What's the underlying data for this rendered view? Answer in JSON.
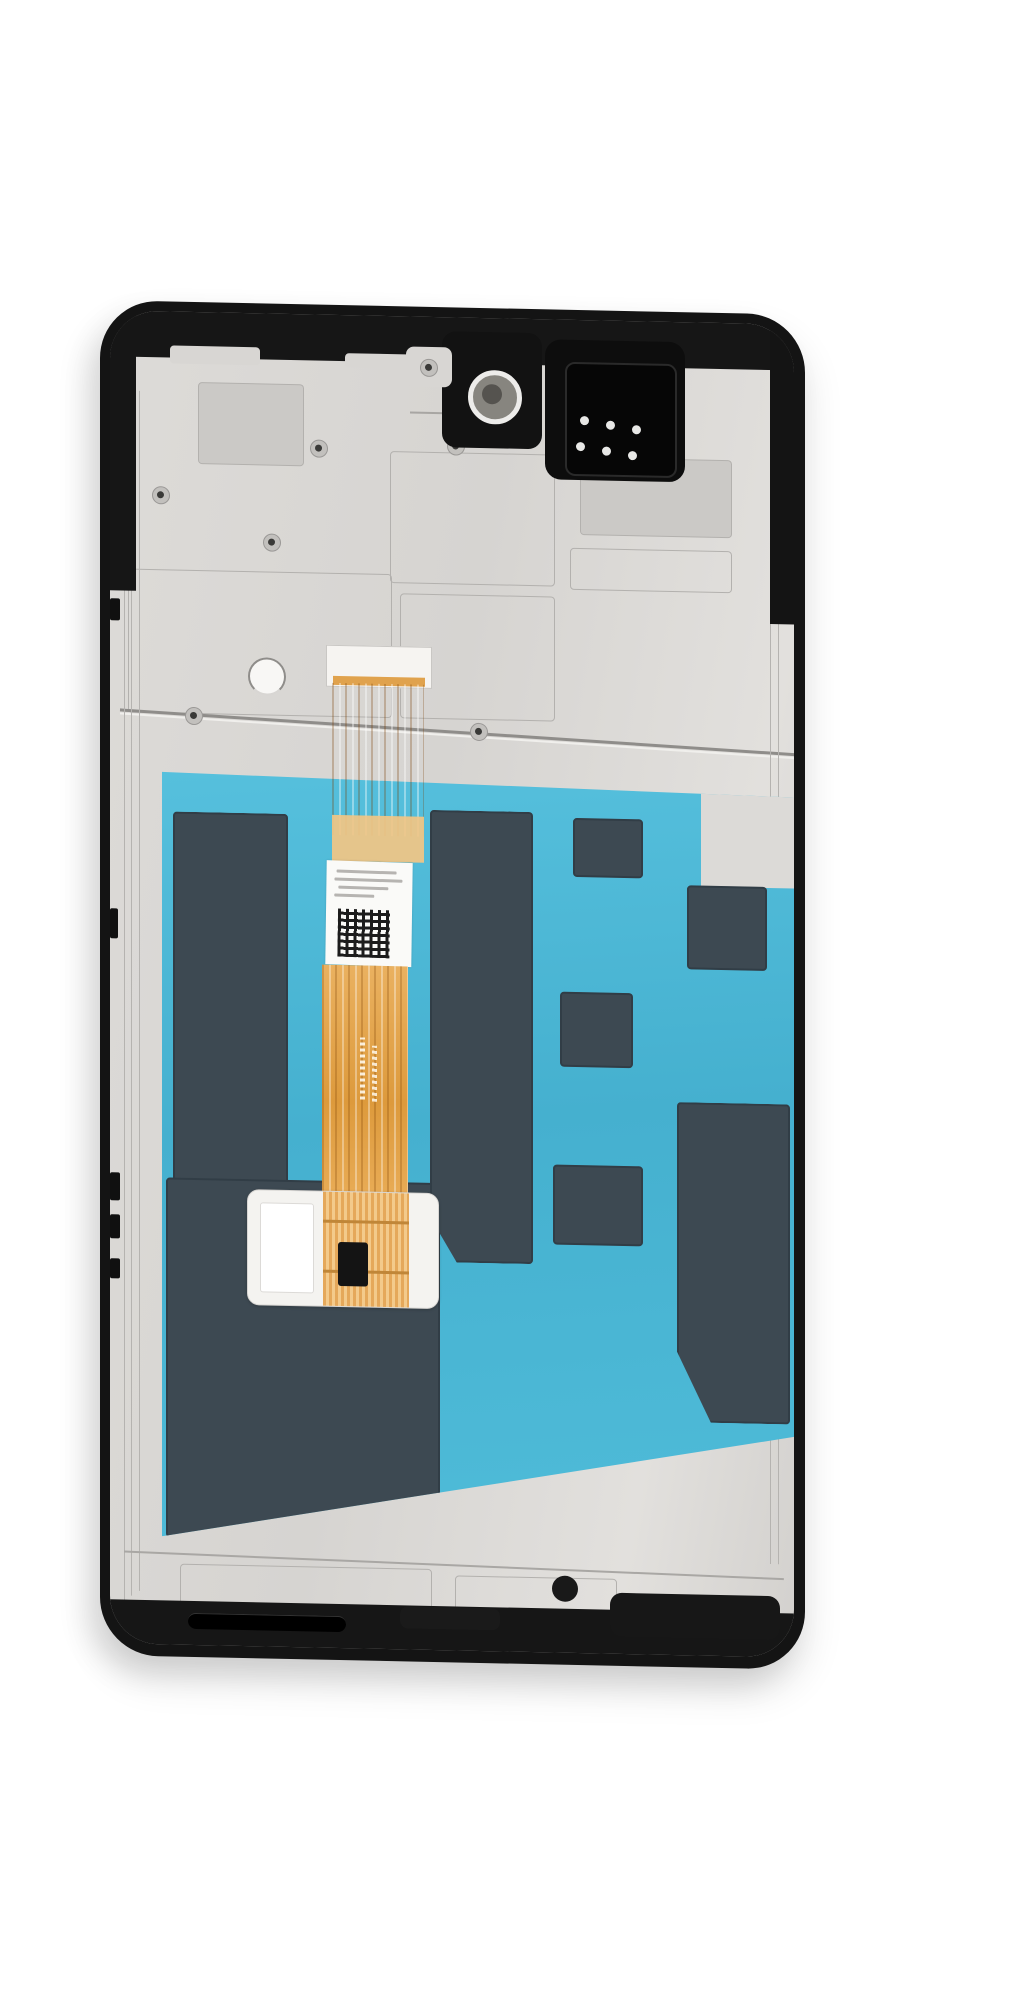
{
  "scene": {
    "kind": "product-photo",
    "subject": "Smartphone LCD screen and digitizer assembly with frame, rear view on white background",
    "background_color": "#ffffff",
    "visible_text": "none legible (tiny gray serial text and markings on flex cable label are illegible)",
    "colors": {
      "frame_black": "#141414",
      "shield_plate_silver": "#d8d6d3",
      "protective_film_cyan": "#48b5d4",
      "graphite_pads_slate": "#3d4952",
      "flex_cable_orange": "#e8a84c",
      "label_white": "#fafaf8"
    },
    "parts": {
      "frame": "midframe with black bezel edge",
      "plate": "silver EMI shield back plate with etched outlines and screw holes",
      "camera": "front camera opening with white ring",
      "earpiece": "earpiece speaker box with six spring contact dots",
      "film": "cyan protective film window",
      "pads": "dark graphite cushion pads on film",
      "flex_connector": "white flex cable stiffener connector",
      "flex_ribbon": "orange LCD flex ribbon cable",
      "qr_label": "white serial label with QR code (text illegible)",
      "foam_pad": "white foam pad with driver IC chip",
      "bond_rail": "black bonded-edge dash marks along right side",
      "bottom_band": "bottom black band with microphone slot and adhesive residue"
    }
  }
}
